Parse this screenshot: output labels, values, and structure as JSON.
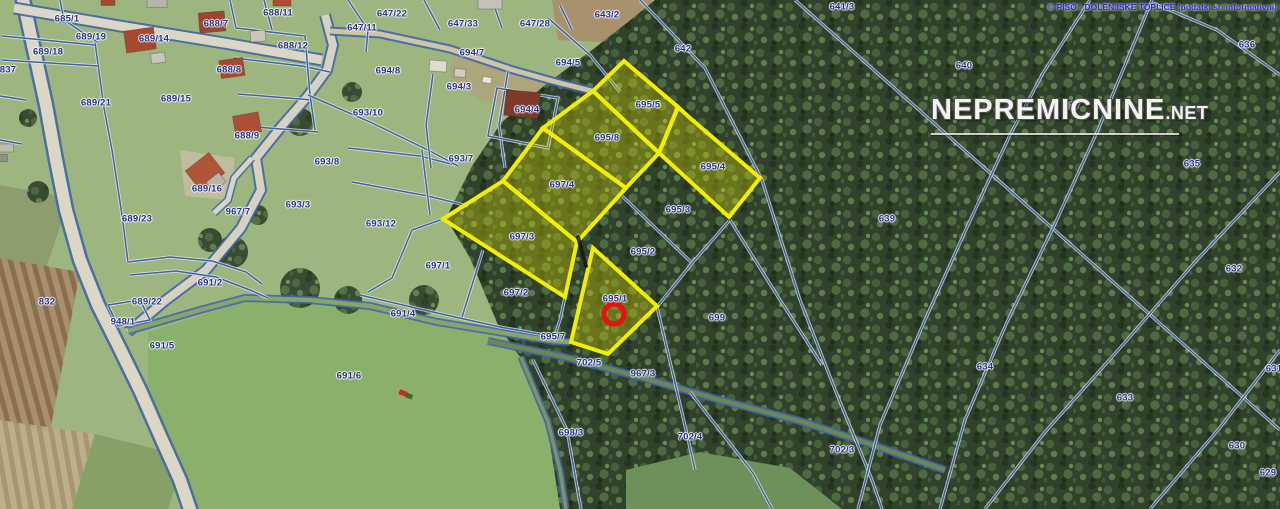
{
  "map": {
    "attribution": "© PISO -  DOLENJSKE TOPLICE (podatki so informativni)",
    "watermark": {
      "main": "NEPREMICNINE",
      "suffix": ".NET"
    },
    "colors": {
      "highlight": "#f2ee00",
      "highlight_fill": "rgba(228,224,0,0.32)",
      "boundary": "#3c63a6",
      "label": "#25308e",
      "marker": "#e81010",
      "attribution": "#2b2bd0"
    },
    "marker": {
      "parcel": "695/1",
      "x": 614,
      "y": 314
    },
    "highlighted_parcels": [
      {
        "id": "695/5",
        "label_x": 648,
        "label_y": 105,
        "polygon": [
          [
            593,
            91
          ],
          [
            624,
            61
          ],
          [
            678,
            107
          ],
          [
            659,
            153
          ]
        ]
      },
      {
        "id": "695/8",
        "label_x": 607,
        "label_y": 138,
        "polygon": [
          [
            543,
            128
          ],
          [
            593,
            91
          ],
          [
            659,
            153
          ],
          [
            626,
            188
          ]
        ]
      },
      {
        "id": "697/4",
        "label_x": 562,
        "label_y": 185,
        "polygon": [
          [
            503,
            181
          ],
          [
            543,
            128
          ],
          [
            626,
            188
          ],
          [
            577,
            242
          ]
        ]
      },
      {
        "id": "697/3",
        "label_x": 522,
        "label_y": 237,
        "polygon": [
          [
            443,
            219
          ],
          [
            503,
            181
          ],
          [
            577,
            242
          ],
          [
            565,
            297
          ]
        ]
      },
      {
        "id": "695/4",
        "label_x": 713,
        "label_y": 167,
        "polygon": [
          [
            678,
            107
          ],
          [
            690,
            118
          ],
          [
            760,
            178
          ],
          [
            729,
            217
          ],
          [
            659,
            153
          ]
        ]
      },
      {
        "id": "695/1",
        "label_x": 615,
        "label_y": 299,
        "polygon": [
          [
            593,
            248
          ],
          [
            657,
            306
          ],
          [
            608,
            354
          ],
          [
            571,
            342
          ]
        ]
      }
    ],
    "parcel_labels": [
      {
        "t": "685/1",
        "x": 67,
        "y": 19
      },
      {
        "t": "689/19",
        "x": 91,
        "y": 37
      },
      {
        "t": "689/18",
        "x": 48,
        "y": 52
      },
      {
        "t": "837",
        "x": 8,
        "y": 70
      },
      {
        "t": "689/14",
        "x": 154,
        "y": 39
      },
      {
        "t": "688/7",
        "x": 216,
        "y": 24
      },
      {
        "t": "688/11",
        "x": 278,
        "y": 13
      },
      {
        "t": "688/12",
        "x": 293,
        "y": 46
      },
      {
        "t": "688/8",
        "x": 229,
        "y": 70
      },
      {
        "t": "689/21",
        "x": 96,
        "y": 103
      },
      {
        "t": "689/15",
        "x": 176,
        "y": 99
      },
      {
        "t": "688/9",
        "x": 247,
        "y": 136
      },
      {
        "t": "689/16",
        "x": 207,
        "y": 189
      },
      {
        "t": "689/23",
        "x": 137,
        "y": 219
      },
      {
        "t": "967/7",
        "x": 238,
        "y": 212
      },
      {
        "t": "693/8",
        "x": 327,
        "y": 162
      },
      {
        "t": "693/3",
        "x": 298,
        "y": 205
      },
      {
        "t": "693/12",
        "x": 381,
        "y": 224
      },
      {
        "t": "691/2",
        "x": 210,
        "y": 283
      },
      {
        "t": "689/22",
        "x": 147,
        "y": 302
      },
      {
        "t": "832",
        "x": 47,
        "y": 302
      },
      {
        "t": "948/1",
        "x": 123,
        "y": 322
      },
      {
        "t": "691/5",
        "x": 162,
        "y": 346
      },
      {
        "t": "691/6",
        "x": 349,
        "y": 376
      },
      {
        "t": "691/4",
        "x": 403,
        "y": 314
      },
      {
        "t": "697/1",
        "x": 438,
        "y": 266
      },
      {
        "t": "697/2",
        "x": 516,
        "y": 293
      },
      {
        "t": "693/7",
        "x": 461,
        "y": 159
      },
      {
        "t": "693/10",
        "x": 368,
        "y": 113
      },
      {
        "t": "694/8",
        "x": 388,
        "y": 71
      },
      {
        "t": "694/7",
        "x": 472,
        "y": 53
      },
      {
        "t": "694/3",
        "x": 459,
        "y": 87
      },
      {
        "t": "694/4",
        "x": 527,
        "y": 110
      },
      {
        "t": "694/5",
        "x": 568,
        "y": 63
      },
      {
        "t": "647/11",
        "x": 362,
        "y": 28
      },
      {
        "t": "647/22",
        "x": 392,
        "y": 14
      },
      {
        "t": "647/33",
        "x": 463,
        "y": 24
      },
      {
        "t": "647/28",
        "x": 535,
        "y": 24
      },
      {
        "t": "643/2",
        "x": 607,
        "y": 15
      },
      {
        "t": "642",
        "x": 683,
        "y": 49
      },
      {
        "t": "641/3",
        "x": 842,
        "y": 7
      },
      {
        "t": "640",
        "x": 964,
        "y": 66
      },
      {
        "t": "636",
        "x": 1247,
        "y": 45
      },
      {
        "t": "637",
        "x": 1072,
        "y": 106
      },
      {
        "t": "635",
        "x": 1192,
        "y": 164
      },
      {
        "t": "639",
        "x": 887,
        "y": 219
      },
      {
        "t": "632",
        "x": 1234,
        "y": 269
      },
      {
        "t": "634",
        "x": 985,
        "y": 367
      },
      {
        "t": "633",
        "x": 1125,
        "y": 398
      },
      {
        "t": "630",
        "x": 1237,
        "y": 446
      },
      {
        "t": "629",
        "x": 1268,
        "y": 473
      },
      {
        "t": "631",
        "x": 1274,
        "y": 369
      },
      {
        "t": "702/3",
        "x": 842,
        "y": 450
      },
      {
        "t": "695/3",
        "x": 678,
        "y": 210
      },
      {
        "t": "695/2",
        "x": 643,
        "y": 252
      },
      {
        "t": "699",
        "x": 717,
        "y": 318
      },
      {
        "t": "695/7",
        "x": 553,
        "y": 337
      },
      {
        "t": "702/5",
        "x": 589,
        "y": 363
      },
      {
        "t": "967/3",
        "x": 643,
        "y": 374
      },
      {
        "t": "698/3",
        "x": 571,
        "y": 433
      },
      {
        "t": "702/4",
        "x": 690,
        "y": 437
      }
    ]
  }
}
